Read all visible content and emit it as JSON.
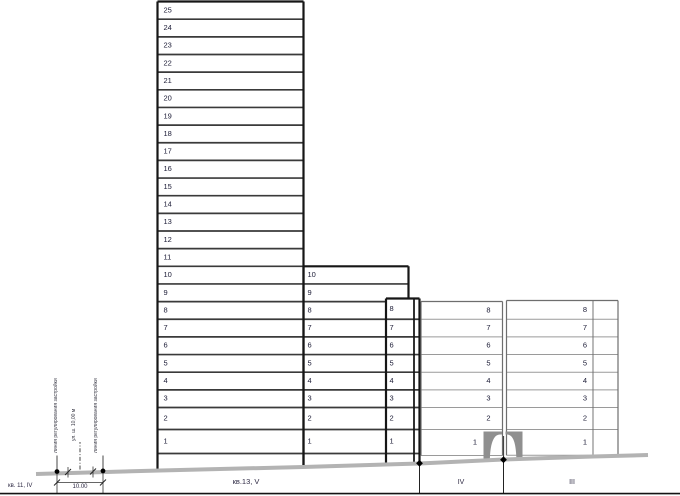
{
  "drawing": {
    "blocks": {
      "left": "кв. 11, IV",
      "center": "кв.13, V",
      "zone_iv": "IV",
      "zone_iii": "III"
    },
    "dimension_label": "10.00",
    "street_lines": {
      "left": "линия регулирования застройки",
      "axis": "ул. ш. 10,00 м",
      "right": "линия регулирования застройки"
    },
    "buildings": [
      {
        "name": "tower-25-storey",
        "floor_labels": [
          "1",
          "2",
          "3",
          "4",
          "5",
          "6",
          "7",
          "8",
          "9",
          "10",
          "11",
          "12",
          "13",
          "14",
          "15",
          "16",
          "17",
          "18",
          "19",
          "20",
          "21",
          "22",
          "23",
          "24",
          "25"
        ]
      },
      {
        "name": "building-10-storey",
        "floor_labels": [
          "1",
          "2",
          "3",
          "4",
          "5",
          "6",
          "7",
          "8",
          "9",
          "10"
        ]
      },
      {
        "name": "building-8-storey-narrow",
        "floor_labels": [
          "1",
          "2",
          "3",
          "4",
          "5",
          "6",
          "7",
          "8"
        ]
      },
      {
        "name": "building-iv-8-storey",
        "floor_labels": [
          "1",
          "2",
          "3",
          "4",
          "5",
          "6",
          "7",
          "8"
        ]
      },
      {
        "name": "building-iii-8-storey",
        "floor_labels": [
          "1",
          "2",
          "3",
          "4",
          "5",
          "6",
          "7",
          "8"
        ]
      }
    ],
    "colors": {
      "ground": "#b3b3b3",
      "dark_wall": "#161616",
      "dark_floor": "#3a3a3a",
      "light_wall": "#6e6e6e",
      "light_floor": "#9a9a9a",
      "arch": "#8f8f8f",
      "label_text": "#20203a",
      "thin_line": "#333333",
      "border": "#141414"
    }
  }
}
